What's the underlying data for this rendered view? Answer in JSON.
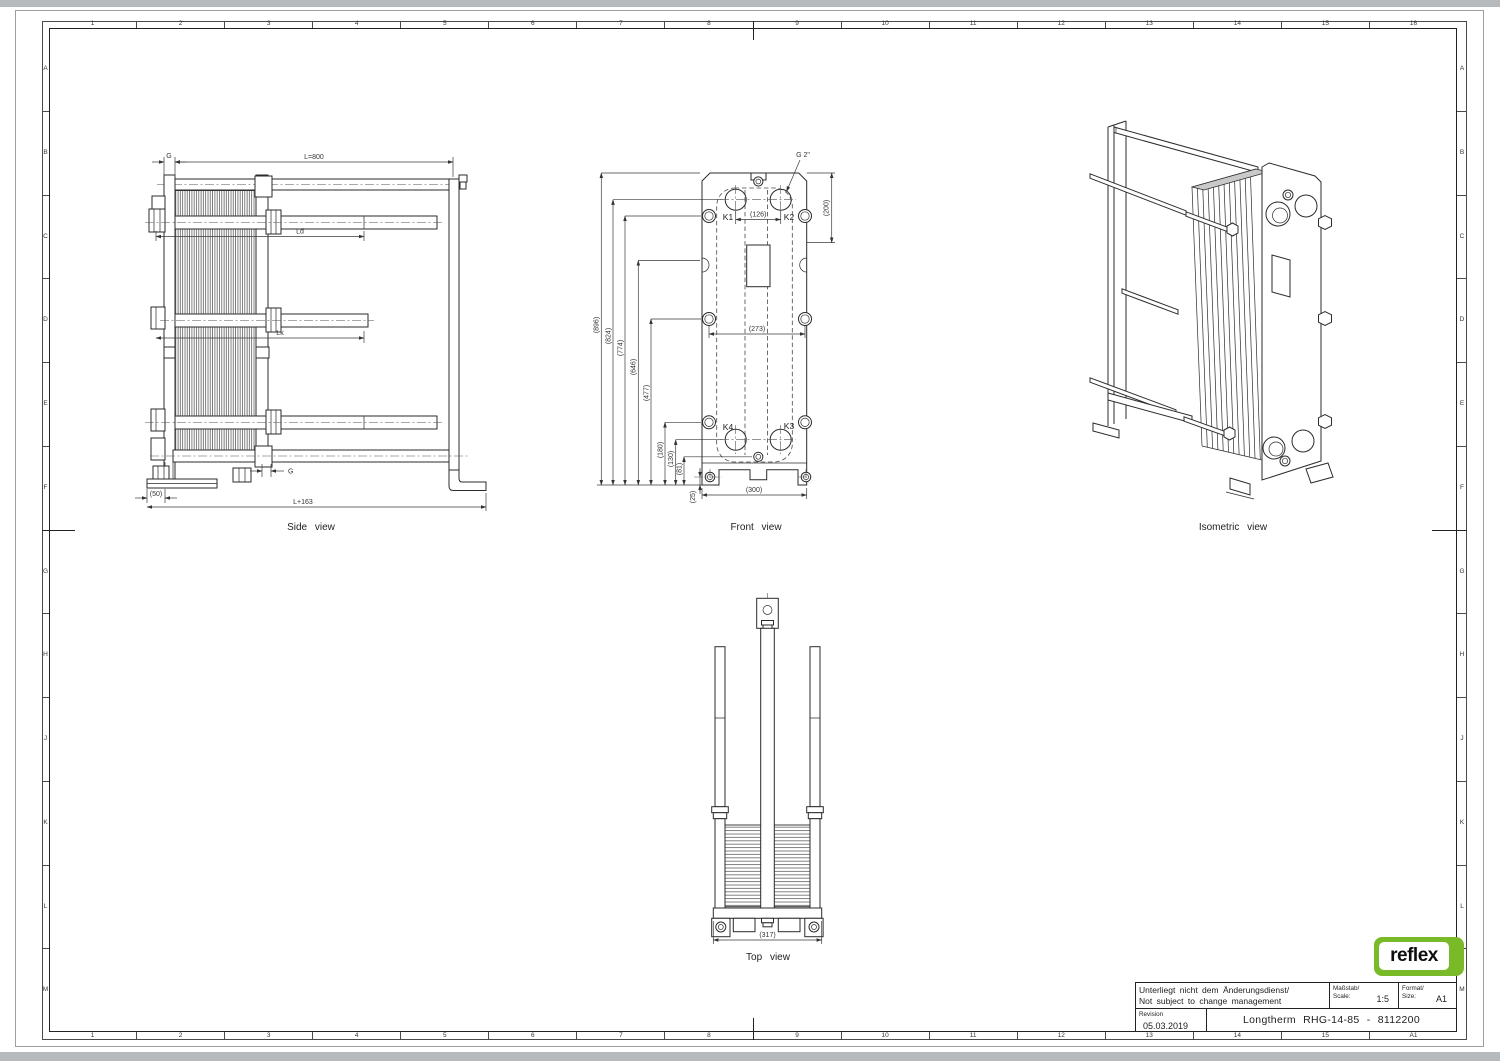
{
  "border": {
    "top": [
      "1",
      "2",
      "3",
      "4",
      "5",
      "6",
      "7",
      "8",
      "9",
      "10",
      "11",
      "12",
      "13",
      "14",
      "15",
      "16"
    ],
    "bottom": [
      "1",
      "2",
      "3",
      "4",
      "5",
      "6",
      "7",
      "8",
      "9",
      "10",
      "11",
      "12",
      "13",
      "14",
      "15",
      "A1"
    ],
    "left": [
      "A",
      "B",
      "C",
      "D",
      "E",
      "F",
      "G",
      "H",
      "J",
      "K",
      "L",
      "M"
    ],
    "right": [
      "A",
      "B",
      "C",
      "D",
      "E",
      "F",
      "G",
      "H",
      "J",
      "K",
      "L",
      "M"
    ]
  },
  "views": {
    "side": {
      "caption": "Side view",
      "dims": {
        "g_top": "G",
        "length": "L=800",
        "ld": "Ld",
        "lk": "Lk",
        "g_bottom": "G",
        "foot": "(50)",
        "total": "L+163"
      }
    },
    "front": {
      "caption": "Front view",
      "connection_label": "G 2\"",
      "ports": {
        "k1": "K1",
        "k2": "K2",
        "k3": "K3",
        "k4": "K4"
      },
      "dims": {
        "d126": "(126)",
        "d200": "(200)",
        "d273": "(273)",
        "d300": "(300)",
        "d25": "(25)"
      },
      "stack": [
        "(896)",
        "(824)",
        "(774)",
        "(646)",
        "(477)",
        "(180)",
        "(130)",
        "(81)"
      ]
    },
    "top": {
      "caption": "Top view",
      "dims": {
        "d317": "(317)"
      }
    },
    "iso": {
      "caption": "Isometric view"
    }
  },
  "title_block": {
    "note_line1": "Unterliegt nicht dem Änderungsdienst/",
    "note_line2": "Not subject to change management",
    "scale_label_de": "Maßstab/",
    "scale_label_en": "Scale:",
    "scale_value": "1:5",
    "format_label_de": "Format/",
    "format_label_en": "Size:",
    "format_value": "A1",
    "revision_label": "Revision",
    "revision_date": "05.03.2019",
    "drawing_title": "Longtherm RHG-14-85 - 8112200",
    "logo_text": "reflex",
    "logo_color": "#79ba28"
  }
}
